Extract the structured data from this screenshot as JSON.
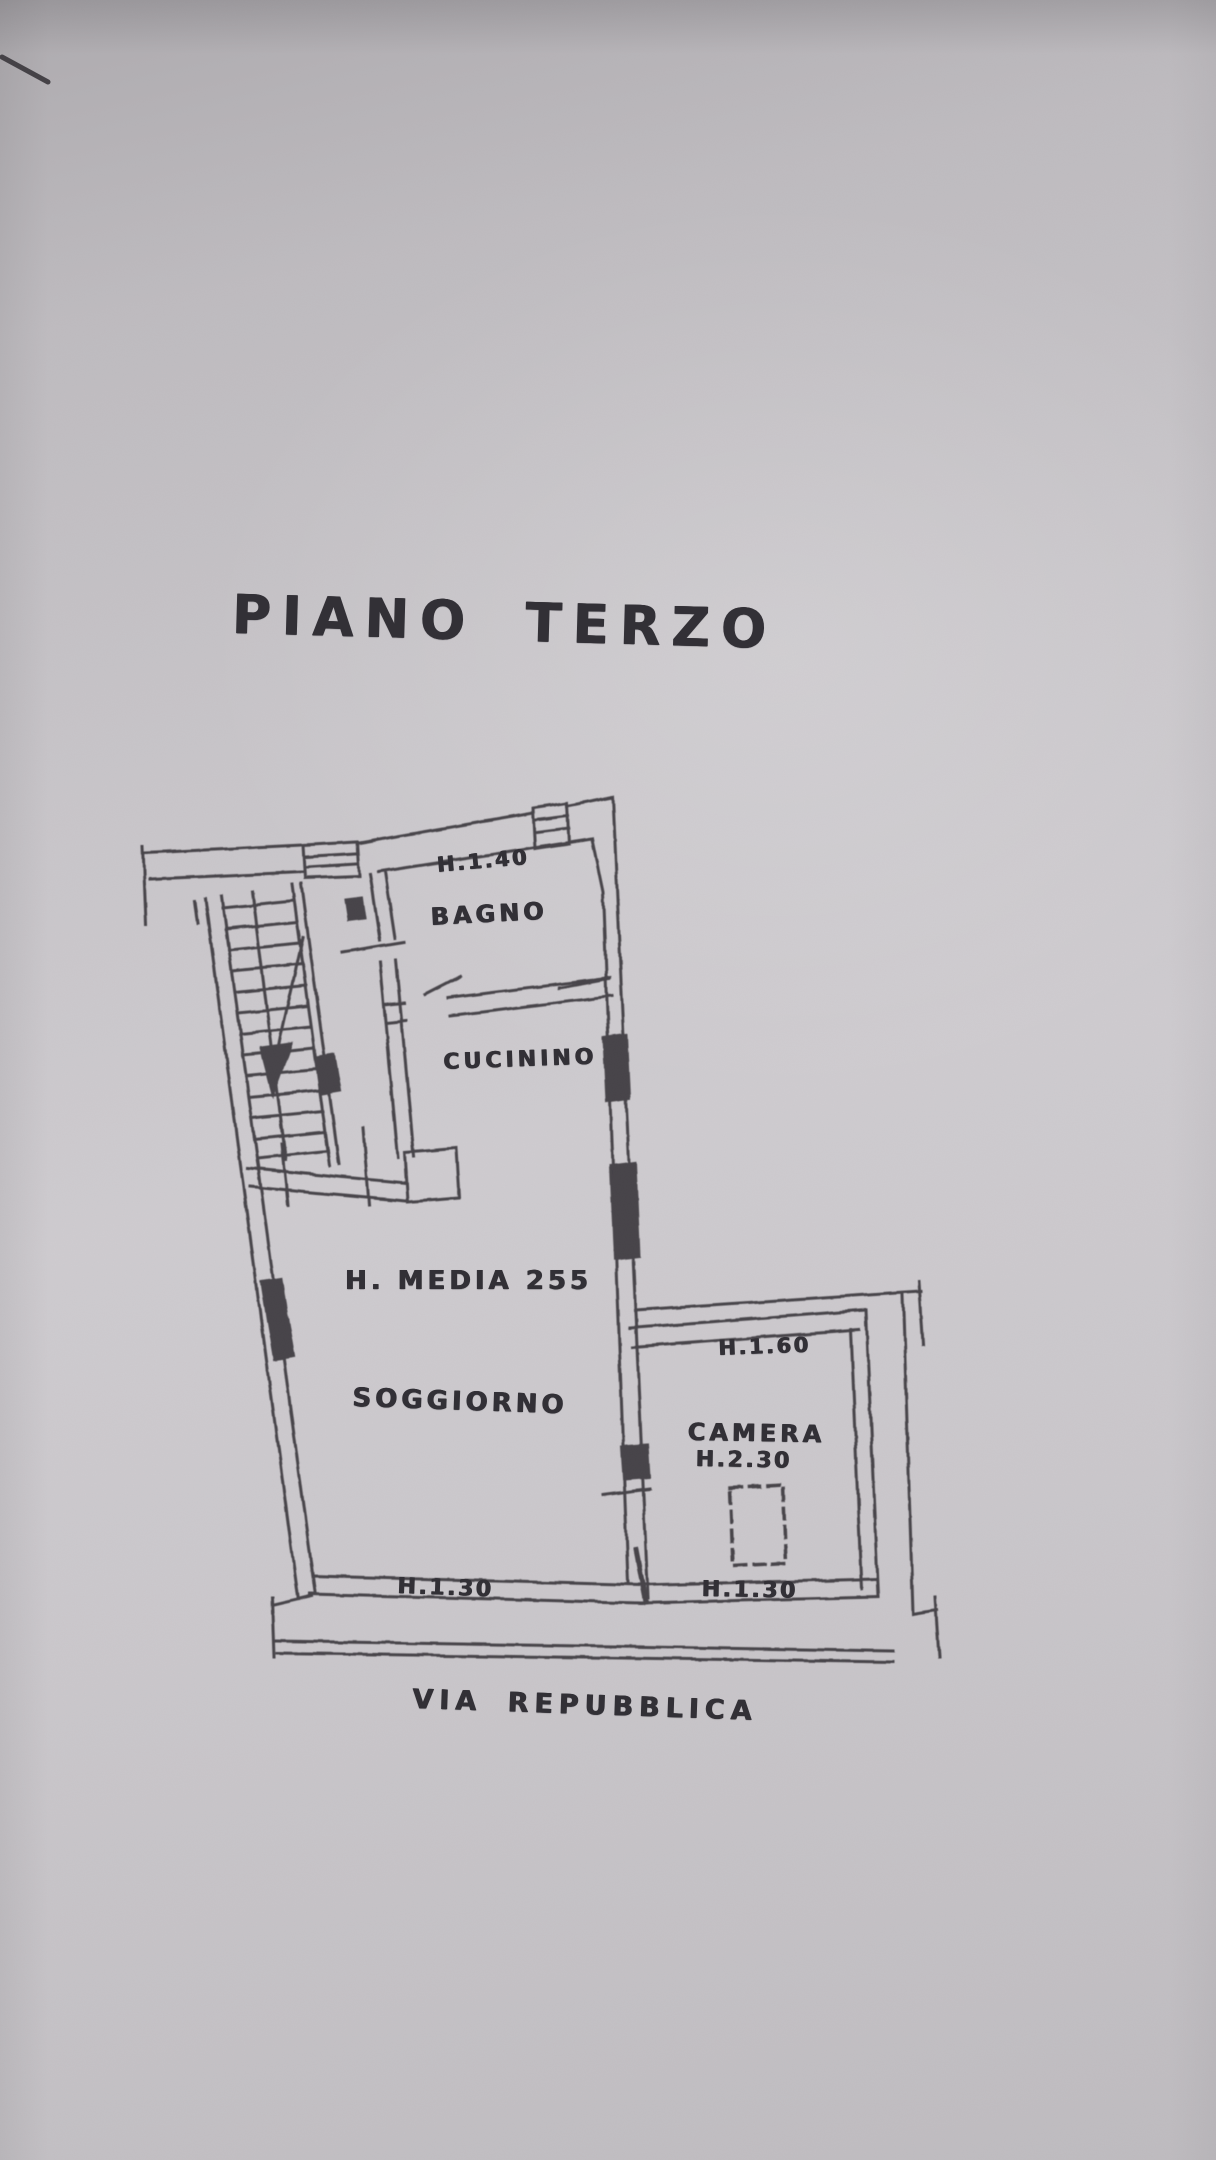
{
  "plan": {
    "title": "PIANO TERZO",
    "street_label": "VIA REPUBBLICA",
    "labels": {
      "bagno_height": "H.1.40",
      "bagno": "BAGNO",
      "cucinino": "CUCININO",
      "soggiorno_avg_height": "H. MEDIA 255",
      "soggiorno": "SOGGIORNO",
      "terrace_height": "H.1.60",
      "camera": "CAMERA",
      "camera_height": "H.2.30",
      "parapet_left_height": "H.1.30",
      "parapet_right_height": "H.1.30"
    },
    "colors": {
      "paper": "#c9c6ca",
      "ink": "#3a373c"
    }
  }
}
